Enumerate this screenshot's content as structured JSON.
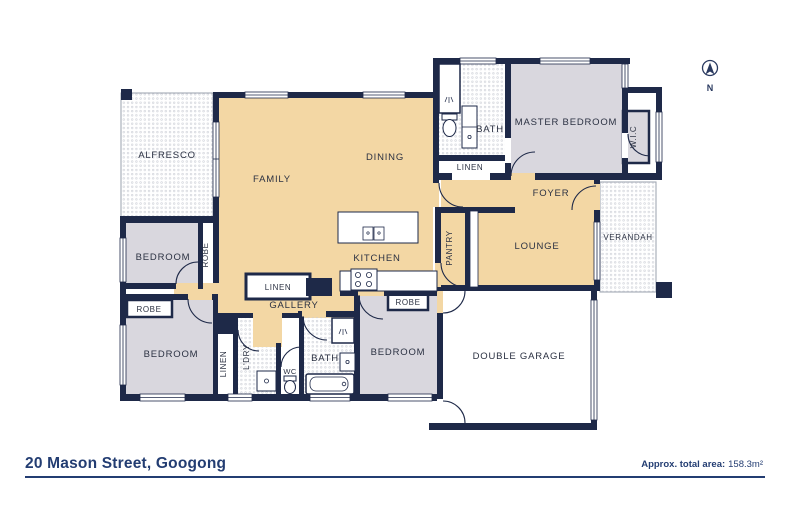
{
  "rooms": {
    "alfresco": "ALFRESCO",
    "family": "FAMILY",
    "dining": "DINING",
    "kitchen": "KITCHEN",
    "bath_ensuite": "BATH",
    "linen_top": "LINEN",
    "master_bedroom": "MASTER BEDROOM",
    "wic": "W.I.C",
    "foyer": "FOYER",
    "lounge": "LOUNGE",
    "pantry": "PANTRY",
    "verandah": "VERANDAH",
    "bedroom_1": "BEDROOM",
    "robe_1": "ROBE",
    "robe_2": "ROBE",
    "bedroom_2": "BEDROOM",
    "linen_mid": "LINEN",
    "gallery": "GALLERY",
    "linen_low": "LINEN",
    "laundry": "L'DRY",
    "wc": "WC",
    "bath_main": "BATH",
    "bedroom_3": "BEDROOM",
    "robe_3": "ROBE",
    "garage": "DOUBLE GARAGE"
  },
  "compass": {
    "north": "N"
  },
  "footer": {
    "title": "20 Mason Street, Googong",
    "area_label": "Approx. total area:",
    "area_value": "158.3m²"
  },
  "colors": {
    "wall": "#1e2948",
    "floor_tan": "#f3d7a4",
    "floor_grey": "#d9d7de",
    "navy_text": "#233d72",
    "dot": "#c9ccd4"
  }
}
